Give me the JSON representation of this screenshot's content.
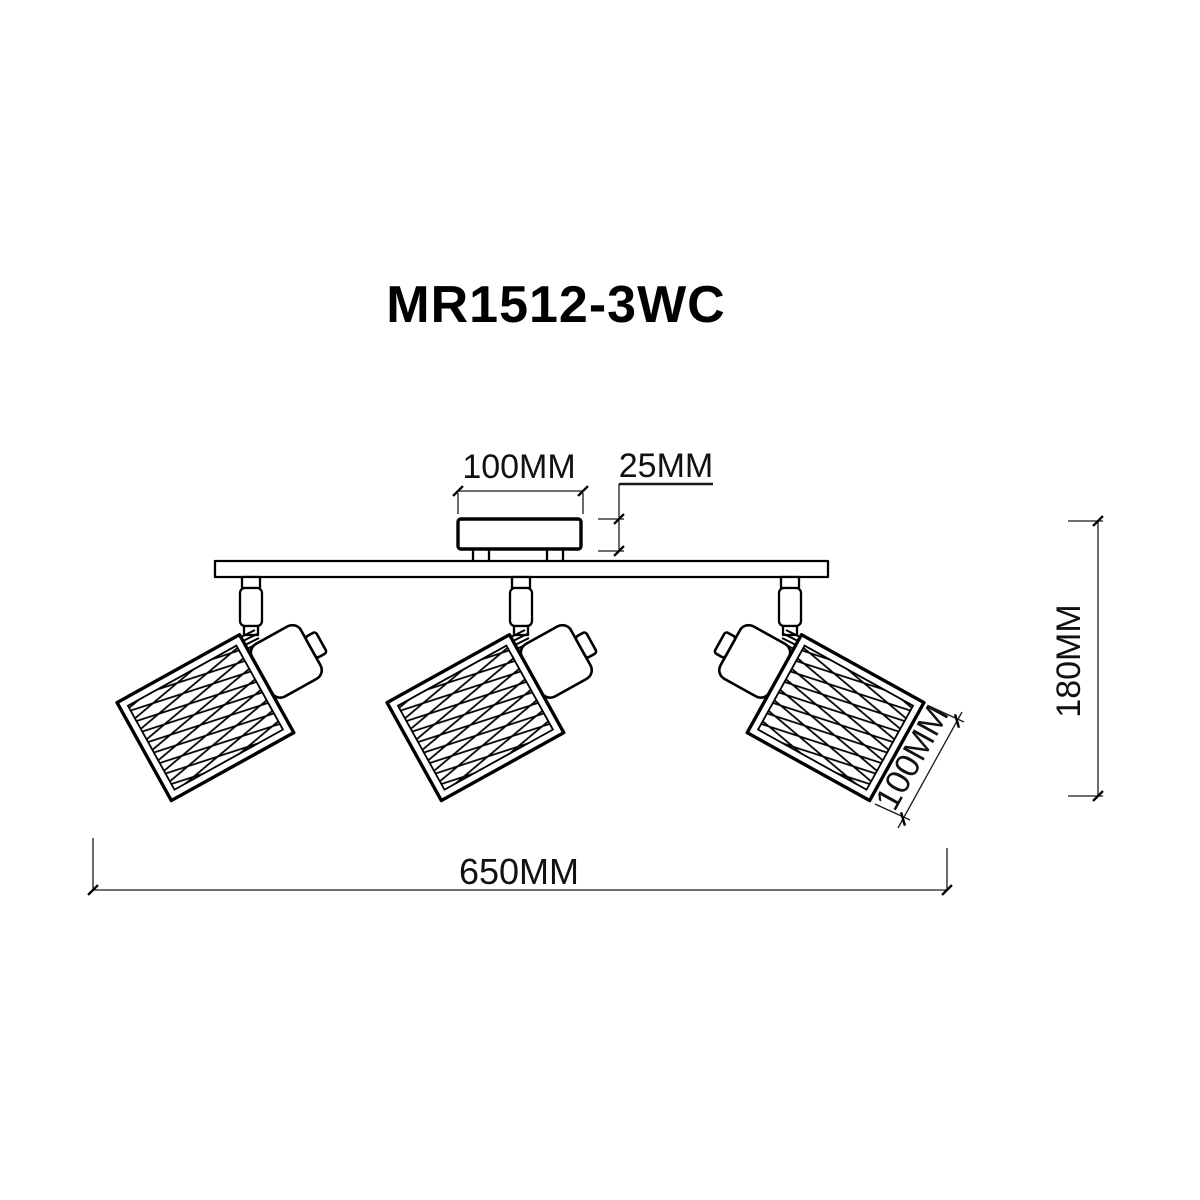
{
  "product_title": "MR1512-3WC",
  "dimensions": {
    "canopy_width": "100MM",
    "canopy_height": "25MM",
    "fixture_height": "180MM",
    "shade_size": "100MM",
    "overall_width": "650MM"
  }
}
